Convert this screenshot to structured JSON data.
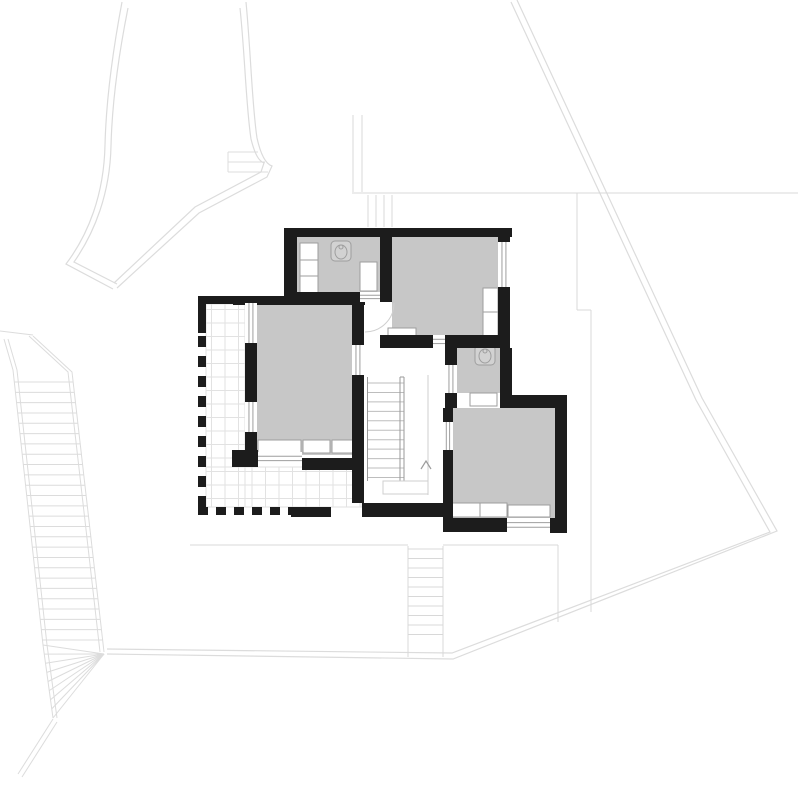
{
  "drawing": {
    "title_semantic": "upper-floor-plan-architectural-drawing",
    "canvas": {
      "width": 800,
      "height": 800,
      "background": "#ffffff"
    },
    "palette": {
      "wall": "#1c1c1c",
      "room_fill": "#c7c7c7",
      "furniture_fill": "#ffffff",
      "furniture_stroke": "#9e9e9e",
      "tile_stroke": "#e2e2e2",
      "site_stroke": "#dcdcdc",
      "lower_stroke": "#d8d8d8",
      "stair_tread": "#bdbdbd",
      "stair_rail": "#9a9a9a",
      "arrow_stroke": "#9c9c9c",
      "arc_stroke": "#cfcfcf"
    },
    "site_boundary_paths": [
      {
        "name": "funnel-left-outer",
        "d": "M 122 2 C 112 55 106 105 105 145 C 104 195 88 235 66 264 L 113 289"
      },
      {
        "name": "funnel-left-inner",
        "d": "M 128 8 C 118 58 112 106 111 146 C 110 193 95 232 74 262 L 117 284"
      },
      {
        "name": "funnel-right-outer",
        "d": "M 246 2 C 251 55 252 105 257 138 C 261 156 266 164 272 166 L 267 177 L 199 213 L 117 288"
      },
      {
        "name": "funnel-right-inner",
        "d": "M 240 8 C 245 56 246 106 251 139 C 255 155 259 161 264 163 L 261 172 L 195 207 L 114 283"
      },
      {
        "name": "east-boundary-outer",
        "d": "M 517 0 L 702 398 L 777 531 L 453 659 L 107 654"
      },
      {
        "name": "east-boundary-inner",
        "d": "M 511 2 L 696 400 L 770 532 L 452 653 L 107 649"
      }
    ],
    "site_step_lines": [
      [
        228,
        152,
        258,
        152
      ],
      [
        228,
        162,
        265,
        162
      ],
      [
        228,
        172,
        268,
        172
      ],
      [
        228,
        152,
        228,
        172
      ]
    ],
    "lower_level_lines": [
      [
        352,
        193,
        798,
        193
      ],
      [
        353,
        115,
        353,
        192
      ],
      [
        362,
        115,
        362,
        192
      ],
      [
        577,
        193,
        577,
        310
      ],
      [
        577,
        310,
        591,
        310
      ],
      [
        591,
        310,
        591,
        612
      ],
      [
        190,
        545,
        408,
        545
      ],
      [
        443,
        545,
        558,
        545
      ],
      [
        558,
        545,
        558,
        622
      ]
    ],
    "top_exterior_stair": {
      "risers_x": [
        368,
        376,
        384,
        392
      ],
      "y0": 195,
      "y1": 227
    },
    "bottom_exterior_stair": {
      "x0": 408,
      "x1": 443,
      "tread_y0": 549,
      "tread_step": 9.5,
      "tread_count": 10,
      "rail_y0": 546,
      "rail_y1": 657
    },
    "left_exterior_stair": {
      "entry": [
        [
          0,
          331
        ],
        [
          33,
          335
        ]
      ],
      "left_rail": [
        [
          4,
          339
        ],
        [
          13,
          370
        ],
        [
          43,
          645
        ],
        [
          53,
          718
        ]
      ],
      "right_rail": [
        [
          33,
          336
        ],
        [
          72,
          372
        ],
        [
          104,
          652
        ]
      ],
      "treads": {
        "y0": 382,
        "y1": 640,
        "count": 26,
        "left_a": [
          13,
          370
        ],
        "left_b": [
          43,
          645
        ],
        "right_a": [
          72,
          372
        ],
        "right_b": [
          104,
          652
        ]
      },
      "fan": {
        "vertex": [
          104,
          654
        ],
        "target_x_a": [
          43,
          645
        ],
        "target_x_b": [
          53,
          718
        ],
        "count": 9
      },
      "exit": [
        [
          53,
          719
        ],
        [
          18,
          774
        ],
        [
          57,
          722
        ],
        [
          22,
          777
        ]
      ]
    },
    "rooms": [
      {
        "name": "bathroom-top",
        "x": 297,
        "y": 236,
        "w": 83,
        "h": 58
      },
      {
        "name": "bedroom-northeast",
        "x": 392,
        "y": 236,
        "w": 106,
        "h": 100
      },
      {
        "name": "bedroom-master",
        "x": 257,
        "y": 305,
        "w": 95,
        "h": 150
      },
      {
        "name": "bathroom-small",
        "x": 457,
        "y": 348,
        "w": 43,
        "h": 45
      },
      {
        "name": "bedroom-southeast",
        "x": 453,
        "y": 408,
        "w": 102,
        "h": 110
      }
    ],
    "walls": [
      [
        287,
        228,
        225,
        9
      ],
      [
        284,
        228,
        13,
        75
      ],
      [
        380,
        236,
        12,
        66
      ],
      [
        297,
        292,
        63,
        10
      ],
      [
        380,
        335,
        53,
        13
      ],
      [
        445,
        335,
        65,
        13
      ],
      [
        498,
        236,
        12,
        8
      ],
      [
        498,
        287,
        12,
        61
      ],
      [
        500,
        348,
        12,
        47
      ],
      [
        445,
        348,
        12,
        17
      ],
      [
        445,
        393,
        12,
        15
      ],
      [
        500,
        395,
        67,
        13
      ],
      [
        555,
        395,
        12,
        138
      ],
      [
        443,
        518,
        64,
        14
      ],
      [
        550,
        518,
        17,
        15
      ],
      [
        443,
        408,
        10,
        14
      ],
      [
        443,
        450,
        10,
        68
      ],
      [
        362,
        503,
        81,
        14
      ],
      [
        352,
        305,
        12,
        40
      ],
      [
        352,
        375,
        12,
        128
      ],
      [
        233,
        296,
        132,
        9
      ],
      [
        245,
        343,
        12,
        59
      ],
      [
        245,
        432,
        12,
        30
      ],
      [
        232,
        450,
        26,
        17
      ],
      [
        302,
        458,
        60,
        12
      ],
      [
        198,
        296,
        35,
        8
      ],
      [
        198,
        296,
        8,
        37
      ],
      [
        291,
        507,
        40,
        10
      ]
    ],
    "windows": [
      {
        "name": "window-ne-bedroom-east",
        "x": 498,
        "y": 242,
        "w": 12,
        "h": 45,
        "o": "v"
      },
      {
        "name": "window-master-north",
        "x": 245,
        "y": 303,
        "w": 12,
        "h": 40,
        "o": "v"
      },
      {
        "name": "window-master-mid",
        "x": 245,
        "y": 402,
        "w": 12,
        "h": 30,
        "o": "v"
      },
      {
        "name": "window-se-bedroom-south",
        "x": 507,
        "y": 518,
        "w": 43,
        "h": 14,
        "o": "h"
      }
    ],
    "door_thresholds": [
      {
        "name": "door-bathroom-top",
        "x": 360,
        "y": 292,
        "w": 20,
        "h": 10,
        "o": "h"
      },
      {
        "name": "door-ne-bedroom",
        "x": 433,
        "y": 335,
        "w": 12,
        "h": 13,
        "o": "h"
      },
      {
        "name": "door-bathroom-small",
        "x": 445,
        "y": 365,
        "w": 12,
        "h": 28,
        "o": "v"
      },
      {
        "name": "door-master",
        "x": 352,
        "y": 345,
        "w": 12,
        "h": 30,
        "o": "v"
      },
      {
        "name": "door-se-bedroom",
        "x": 443,
        "y": 422,
        "w": 10,
        "h": 28,
        "o": "v"
      },
      {
        "name": "door-terrace",
        "x": 258,
        "y": 452,
        "w": 44,
        "h": 13,
        "o": "h"
      }
    ],
    "furniture": [
      [
        300,
        243,
        18,
        17
      ],
      [
        300,
        260,
        18,
        16
      ],
      [
        300,
        276,
        18,
        17
      ],
      [
        360,
        262,
        17,
        29
      ],
      [
        483,
        288,
        15,
        24
      ],
      [
        483,
        312,
        15,
        24
      ],
      [
        388,
        328,
        28,
        12
      ],
      [
        258,
        440,
        43,
        15
      ],
      [
        303,
        440,
        27,
        13
      ],
      [
        332,
        440,
        28,
        13
      ],
      [
        470,
        393,
        27,
        13
      ],
      [
        452,
        503,
        28,
        14
      ],
      [
        480,
        503,
        27,
        14
      ],
      [
        508,
        505,
        42,
        12
      ]
    ],
    "toilets": [
      {
        "name": "toilet-bathroom-top",
        "x": 331,
        "y": 241,
        "w": 20,
        "h": 20
      },
      {
        "name": "toilet-bathroom-small",
        "x": 475,
        "y": 345,
        "w": 20,
        "h": 20
      }
    ],
    "terrace": {
      "tile_rects": [
        [
          206,
          304,
          39,
          203
        ],
        [
          206,
          467,
          156,
          40
        ]
      ],
      "origin": [
        198,
        296
      ],
      "tile_size": 13.5,
      "dash_runs": [
        {
          "x": 198,
          "y": 336,
          "len": 171,
          "thick": 8,
          "dir": "v",
          "dash": 11,
          "gap": 9
        },
        {
          "x": 198,
          "y": 507,
          "len": 93,
          "thick": 8,
          "dir": "h",
          "dash": 10,
          "gap": 8
        }
      ]
    },
    "main_stair": {
      "tread_x0": 368,
      "tread_x1": 404,
      "tread_y0": 383,
      "tread_step": 9.45,
      "tread_count": 11,
      "left_edge": [
        367.5,
        377,
        367.5,
        481
      ],
      "rail_lines": [
        [
          400,
          377,
          400,
          481
        ],
        [
          404,
          377,
          404,
          481
        ],
        [
          400,
          377,
          404,
          377
        ],
        [
          400,
          481,
          404,
          481
        ]
      ],
      "well_edge": [
        428,
        375,
        428,
        495
      ],
      "landing": [
        383,
        481,
        45,
        13
      ],
      "arrow": [
        [
          421,
          469
        ],
        [
          426,
          461
        ],
        [
          431,
          469
        ]
      ]
    },
    "door_arcs": [
      {
        "name": "arc-bathroom-top-door",
        "d": "M 394 303 A 29 29 0 0 1 365 332"
      }
    ]
  }
}
